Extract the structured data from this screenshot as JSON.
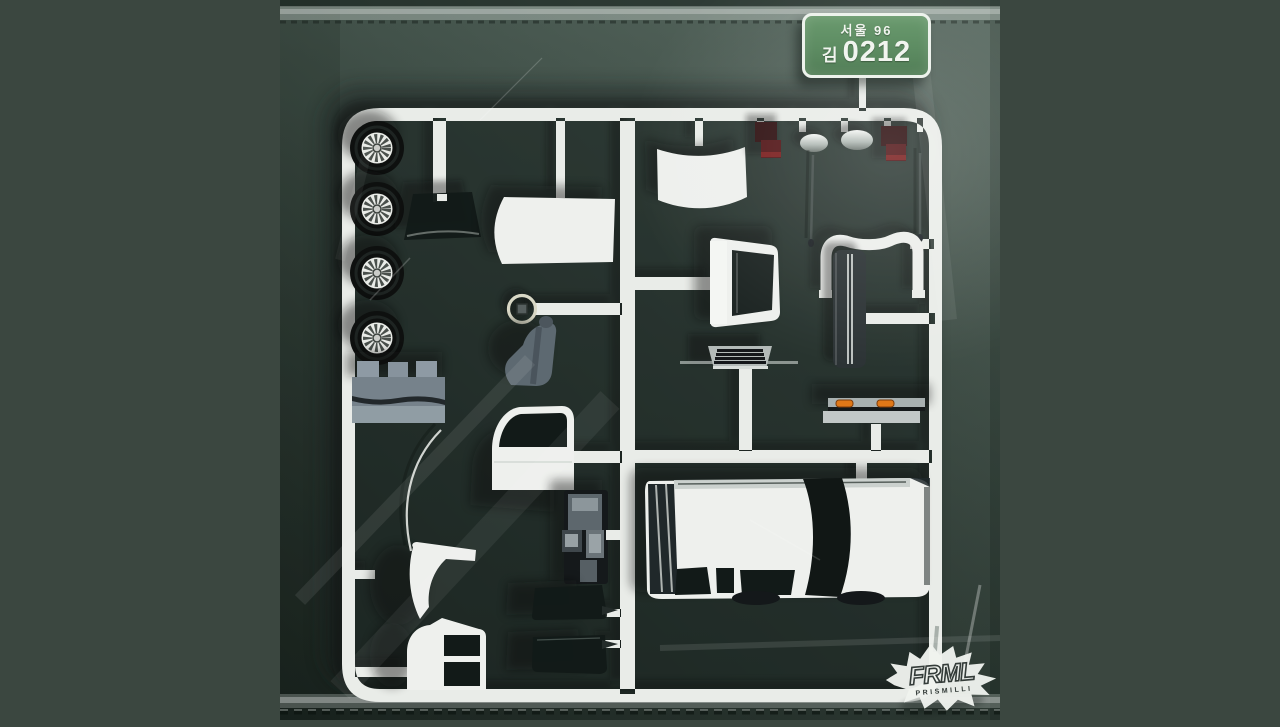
{
  "artwork": {
    "alt": "Plastic model car kit sprue sealed in a crinkled green poly bag, album cover art"
  },
  "license_plate": {
    "region": "서울 96",
    "prefix": "김",
    "number": "0212"
  },
  "logo": {
    "title": "FRML",
    "subtitle": "PRISMILLI"
  },
  "colors": {
    "page_background": "#3b4740",
    "bag_light": "#5c6d64",
    "bag_mid": "#43534b",
    "bag_dark": "#242f2a",
    "sprue": "#e9ece8",
    "part_white": "#eef0ed",
    "glass": "#121a18",
    "interior_gray": "#5c6870",
    "tail_light_red": "#521517",
    "indicator_orange": "#e07818",
    "tire_black": "#0e100f",
    "plate_green": "#5d8c62"
  },
  "parts": [
    {
      "name": "wheel-tire",
      "count": 4
    },
    {
      "name": "bench-seat-row",
      "count": 1
    },
    {
      "name": "windshield-glass",
      "count": 1
    },
    {
      "name": "roof-panel",
      "count": 1
    },
    {
      "name": "steering-wheel",
      "count": 1
    },
    {
      "name": "bucket-seat",
      "count": 1
    },
    {
      "name": "hood-panel",
      "count": 1
    },
    {
      "name": "tail-lamp",
      "count": 2
    },
    {
      "name": "side-mirror",
      "count": 2
    },
    {
      "name": "wiper-rod",
      "count": 2
    },
    {
      "name": "hatch-frame",
      "count": 1
    },
    {
      "name": "vent-grille",
      "count": 1
    },
    {
      "name": "bumper-arch",
      "count": 1
    },
    {
      "name": "molding-strip",
      "count": 1
    },
    {
      "name": "rear-bumper-indicators",
      "count": 1
    },
    {
      "name": "front-door",
      "count": 1
    },
    {
      "name": "dashboard-console",
      "count": 1
    },
    {
      "name": "car-body-shell",
      "count": 1
    },
    {
      "name": "front-fender",
      "count": 1
    },
    {
      "name": "antenna-wire",
      "count": 1
    },
    {
      "name": "rear-quarter-panel",
      "count": 1
    },
    {
      "name": "loose-door-glass",
      "count": 2
    }
  ]
}
